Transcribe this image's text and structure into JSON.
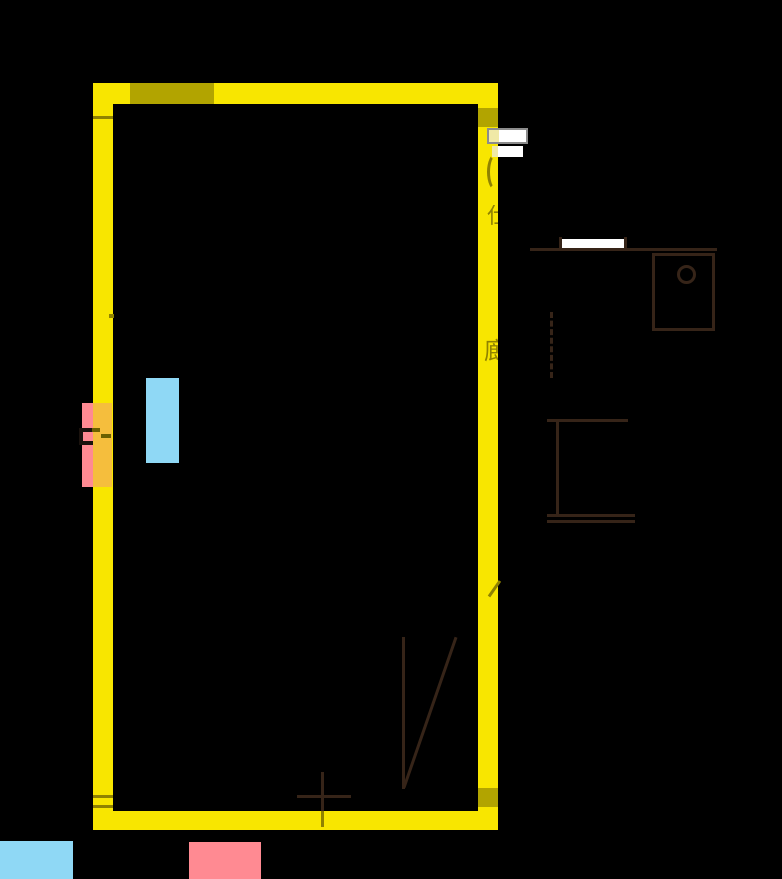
{
  "title": "apartment-floor-plan",
  "colors": {
    "background": "#000000",
    "highlight-yellow": "#F8E600",
    "overlap-olive": "#B2A400",
    "dark-olive": "#8F8200",
    "line-brown": "#362418",
    "highlight-blue": "#8FD8F5",
    "highlight-pink": "#FF8A92",
    "overlap-orange": "#F5BE3D",
    "door-white": "#FFFFFF",
    "door-border-grey": "#8C8C8C",
    "pale-yellow": "#F0E9A6"
  },
  "glyphs": {
    "wall_label_1": "仕",
    "wall_label_2": "廊"
  },
  "legend": {
    "items": [
      {
        "name": "blue-highlight",
        "color": "#8FD8F5"
      },
      {
        "name": "pink-highlight",
        "color": "#FF8A92"
      }
    ]
  }
}
